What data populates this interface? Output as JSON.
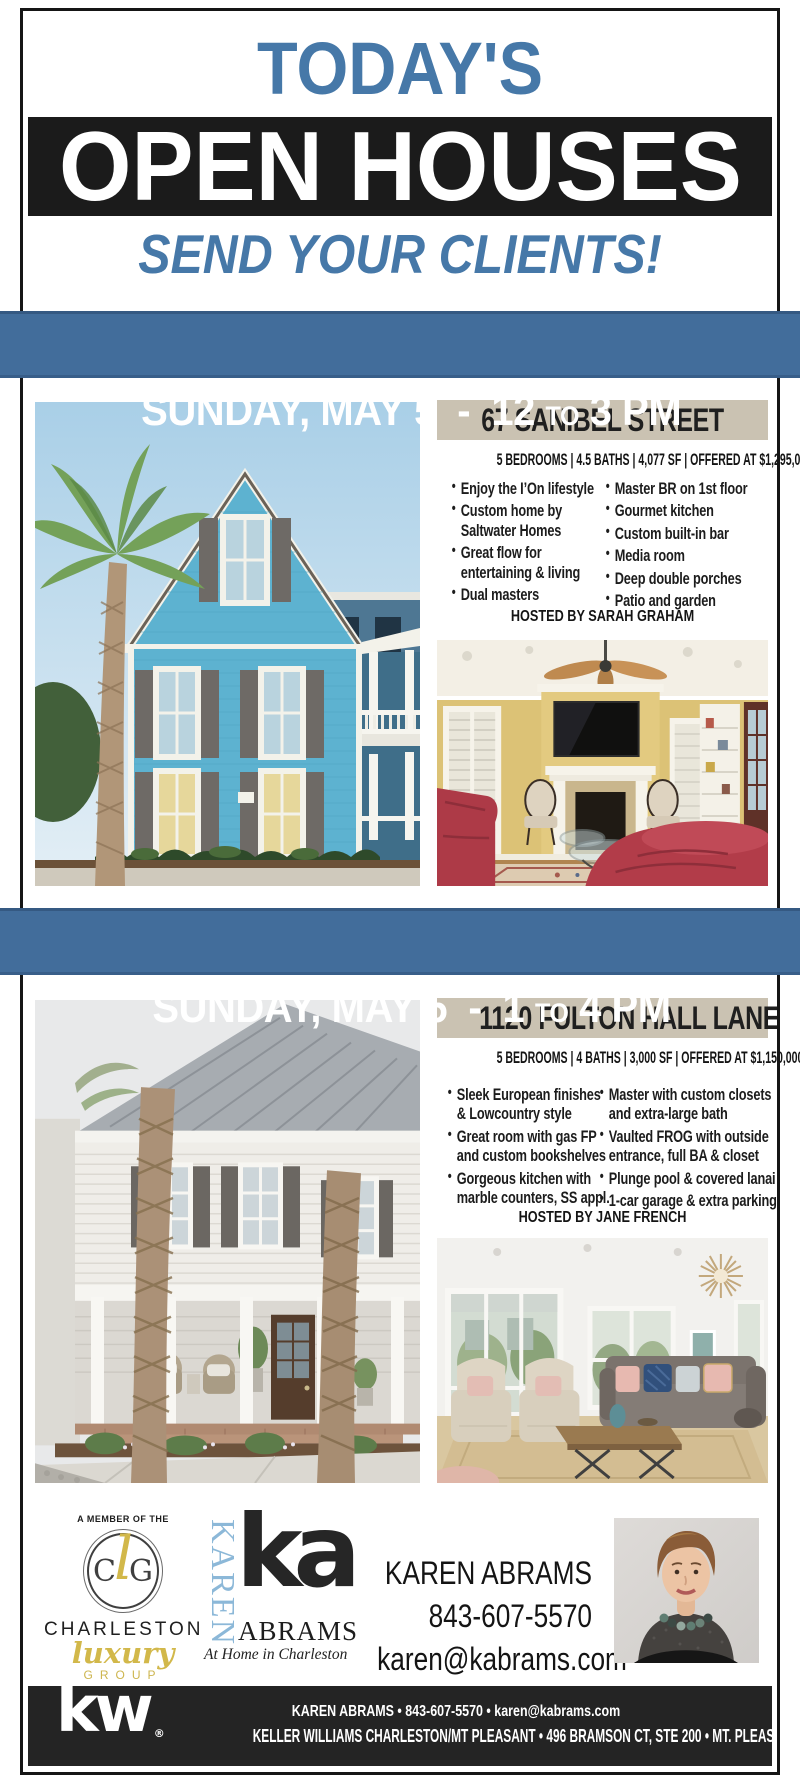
{
  "colors": {
    "accent_blue": "#4678a8",
    "banner_blue": "#426d9b",
    "band_black": "#1b1b1b",
    "tan_bar": "#cac2b2",
    "gold": "#d2b84a"
  },
  "glyphs": {
    "bullet": "•"
  },
  "header": {
    "kicker": "TODAY'S",
    "title": "OPEN HOUSES",
    "subtitle": "SEND YOUR CLIENTS!"
  },
  "listings": [
    {
      "banner": {
        "left": "SUNDAY, MAY 5  -  12 ",
        "to": "TO",
        "right": " 3 PM"
      },
      "address": "67 SANIBEL STREET",
      "specs": "5 BEDROOMS | 4.5 BATHS | 4,077 SF | OFFERED AT $1,295,000",
      "bullets_left": [
        "Enjoy the I’On lifestyle",
        "Custom home by\nSaltwater Homes",
        "Great flow for\nentertaining & living",
        "Dual masters"
      ],
      "bullets_right": [
        "Master BR on 1st floor",
        "Gourmet kitchen",
        "Custom built-in bar",
        "Media room",
        "Deep double porches",
        "Patio and garden"
      ],
      "hosted_by": "HOSTED BY SARAH GRAHAM"
    },
    {
      "banner": {
        "left": "SUNDAY, MAY 5  -  1 ",
        "to": "TO",
        "right": " 4 PM"
      },
      "address": "1120 FULTON HALL LANE",
      "specs": "5 BEDROOMS | 4 BATHS | 3,000 SF | OFFERED AT $1,150,000",
      "bullets_left": [
        "Sleek European finishes\n& Lowcountry style",
        "Great room with gas FP\nand custom bookshelves",
        "Gorgeous kitchen with\nmarble counters, SS appl."
      ],
      "bullets_right": [
        "Master with custom closets\nand extra-large bath",
        "Vaulted FROG with outside\nentrance, full BA & closet",
        "Plunge pool & covered lanai",
        "1-car garage & extra parking"
      ],
      "hosted_by": "HOSTED BY JANE FRENCH"
    }
  ],
  "footer": {
    "clg": {
      "member_line": "A MEMBER OF THE",
      "mono_c": "C",
      "mono_l": "l",
      "mono_g": "G",
      "name": "CHARLESTON",
      "script": "luxury",
      "group": "GROUP"
    },
    "ka": {
      "vertical": "KAREN",
      "monogram": "ka",
      "surname": "ABRAMS",
      "tagline": "At Home in Charleston"
    },
    "agent": {
      "name": "KAREN ABRAMS",
      "phone": "843-607-5570",
      "email": "karen@kabrams.com"
    }
  },
  "bottom_bar": {
    "kw_logo": "kw",
    "registered": "®",
    "line1": "KAREN ABRAMS • 843-607-5570 • karen@kabrams.com",
    "line2": "KELLER WILLIAMS CHARLESTON/MT PLEASANT • 496 BRAMSON CT, STE 200 • MT. PLEASANT, SC 29464"
  }
}
